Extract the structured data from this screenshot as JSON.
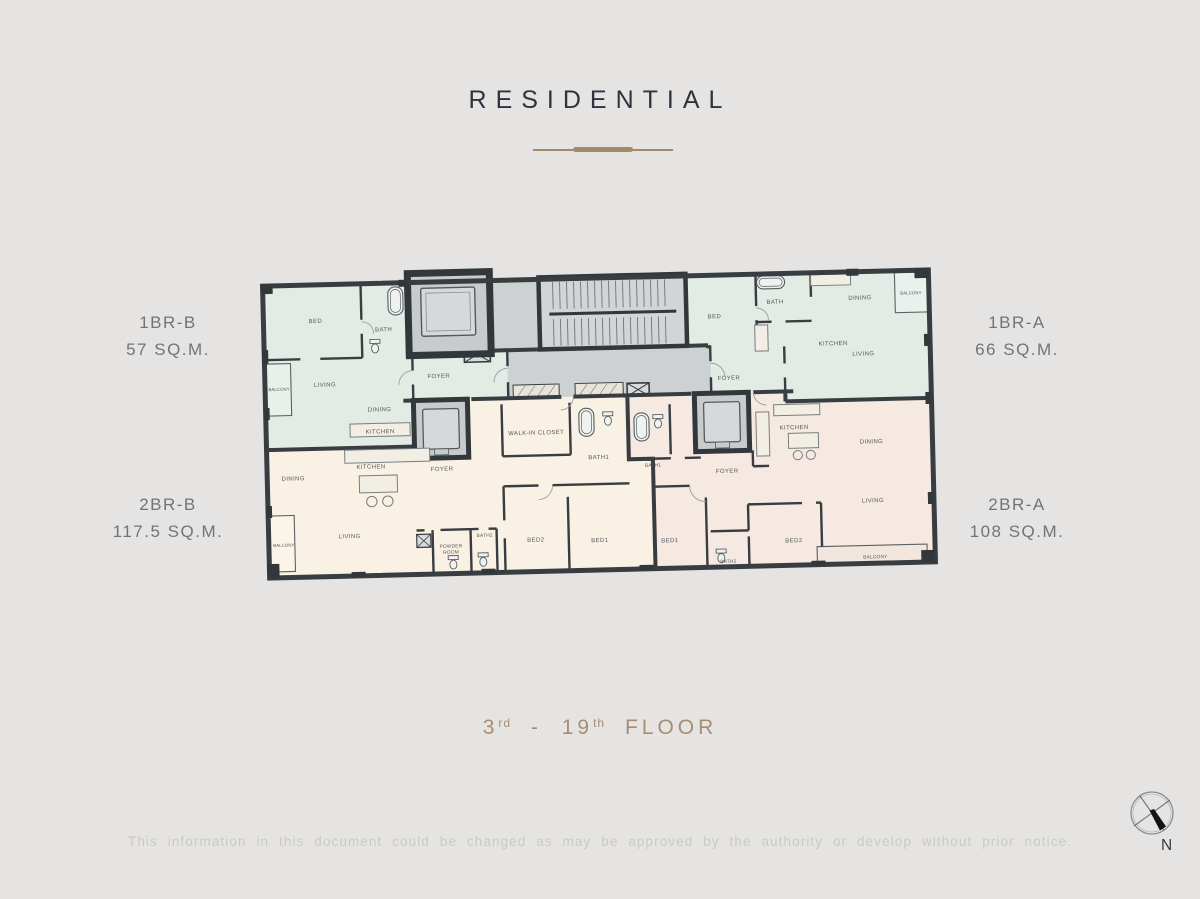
{
  "title": "RESIDENTIAL",
  "floor": {
    "from_num": "3",
    "from_suffix": "rd",
    "separator": "-",
    "to_num": "19",
    "to_suffix": "th",
    "word": "FLOOR"
  },
  "disclaimer": "This information in this document could be changed as may be approved by the authority or develop without prior notice.",
  "compass": {
    "north_label": "N"
  },
  "units": [
    {
      "name": "1BR-B",
      "area": "57 SQ.M."
    },
    {
      "name": "1BR-A",
      "area": "66 SQ.M."
    },
    {
      "name": "2BR-B",
      "area": "117.5 SQ.M."
    },
    {
      "name": "2BR-A",
      "area": "108 SQ.M."
    }
  ],
  "plan": {
    "rooms": [
      {
        "label": "BED"
      },
      {
        "label": "BATH"
      },
      {
        "label": "BALCONY"
      },
      {
        "label": "LIVING"
      },
      {
        "label": "DINING"
      },
      {
        "label": "KITCHEN"
      },
      {
        "label": "FOYER"
      },
      {
        "label": "BED"
      },
      {
        "label": "BATH"
      },
      {
        "label": "DINING"
      },
      {
        "label": "BALCONY"
      },
      {
        "label": "KITCHEN"
      },
      {
        "label": "LIVING"
      },
      {
        "label": "FOYER"
      },
      {
        "label": "DINING"
      },
      {
        "label": "KITCHEN"
      },
      {
        "label": "FOYER"
      },
      {
        "label": "LIVING"
      },
      {
        "label": "BALCONY"
      },
      {
        "label": "POWDER"
      },
      {
        "label": "ROOM"
      },
      {
        "label": "BATH2"
      },
      {
        "label": "WALK-IN CLOSET"
      },
      {
        "label": "BATH1"
      },
      {
        "label": "BED2"
      },
      {
        "label": "BED1"
      },
      {
        "label": "BATH1"
      },
      {
        "label": "FOYER"
      },
      {
        "label": "BED1"
      },
      {
        "label": "BATH2"
      },
      {
        "label": "KITCHEN"
      },
      {
        "label": "DINING"
      },
      {
        "label": "LIVING"
      },
      {
        "label": "BED2"
      },
      {
        "label": "BALCONY"
      }
    ]
  },
  "colors": {
    "background": "#e5e4e2",
    "wall": "#383d41",
    "unit_1br": "#e2ebe4",
    "unit_2br_b": "#f9f1e4",
    "unit_2br_a": "#f6e9e2",
    "corridor": "#ced1d1",
    "accent": "#a18a66",
    "unit_label_gray": "#6d757b",
    "floor_text": "#a78e73",
    "disclaimer_gray": "#c9c9c7"
  }
}
